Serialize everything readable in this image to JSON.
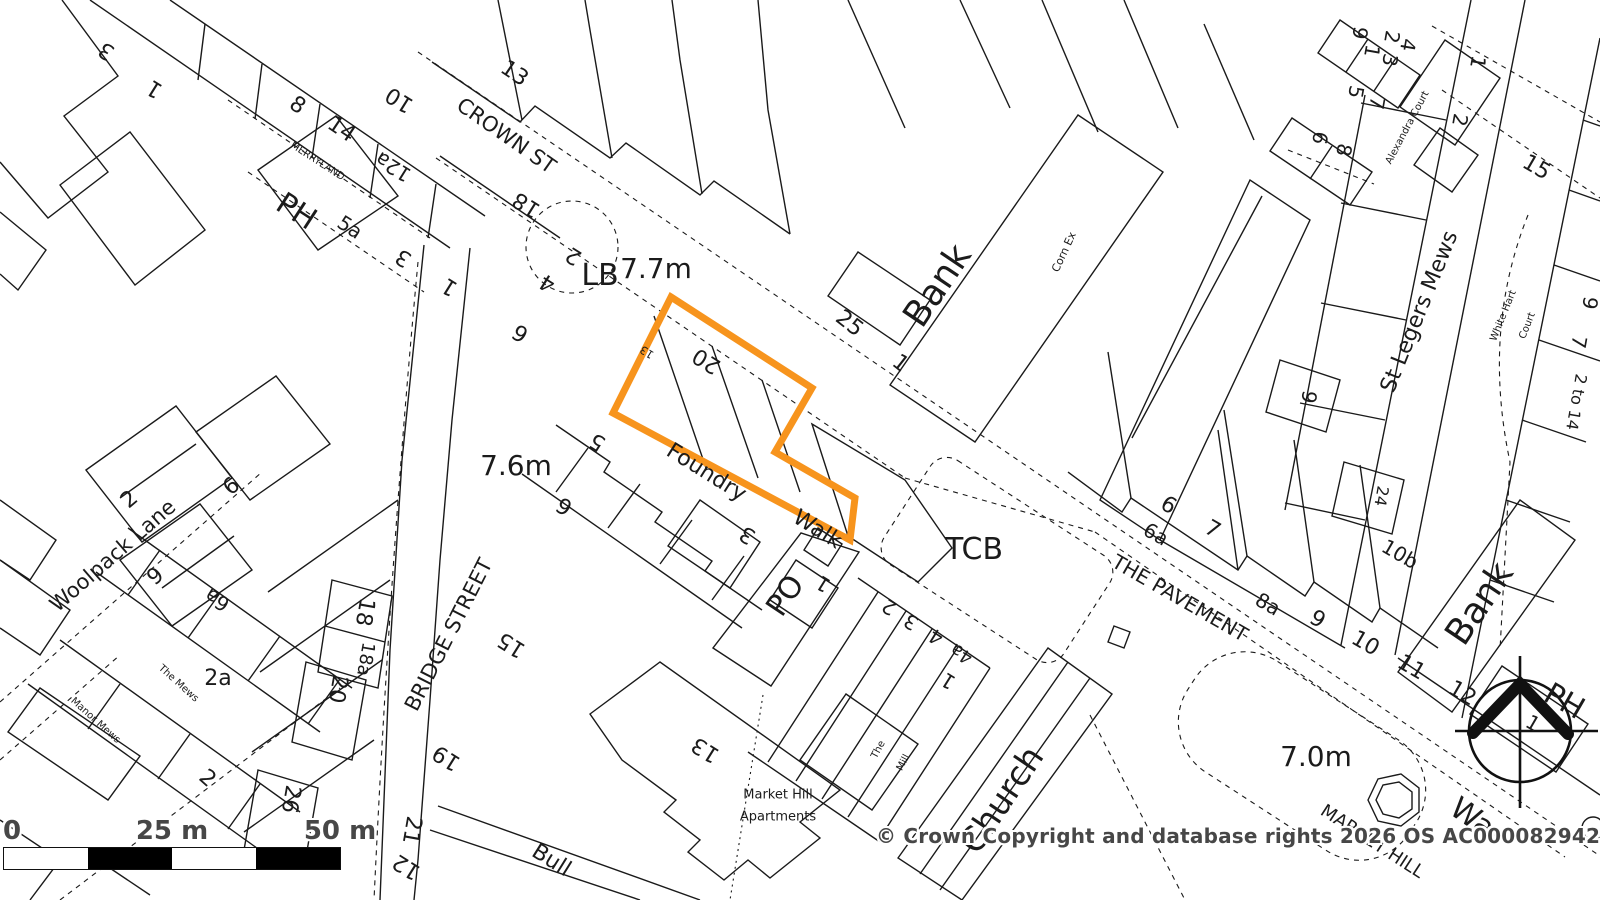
{
  "map": {
    "title": "OS planning map extract",
    "plot": {
      "points_str": "671,297 812,388 775,452 855,498 850,540 613,413",
      "color": "#f7941d"
    },
    "copyright": "© Crown Copyright and database rights 2026 OS AC0000829429",
    "scale_bar": {
      "zero": "0",
      "mid": "25 m",
      "end": "50 m"
    },
    "spot_heights": [
      "7.7m",
      "7.6m",
      "7.0m"
    ],
    "street_names": [
      "CROWN ST",
      "MERRYLAND",
      "BRIDGE STREET",
      "Woolpack Lane",
      "THE PAVEMENT",
      "St Legers Mews",
      "Foundry Walk",
      "MARKET HILL",
      "Bull"
    ],
    "place_names": [
      "PH",
      "LB",
      "TCB",
      "PO",
      "Bank",
      "Corn Ex",
      "Church",
      "War",
      "Alexandra Court",
      "White Hart Court",
      "The Mews",
      "Manor Mews",
      "Market Hill Apartments",
      "The Mill"
    ],
    "labels": [
      {
        "t": "3",
        "x": 107,
        "y": 50,
        "r": 212,
        "s": 22
      },
      {
        "t": "1",
        "x": 155,
        "y": 88,
        "r": 212,
        "s": 22
      },
      {
        "t": "8",
        "x": 297,
        "y": 106,
        "r": 34,
        "s": 22
      },
      {
        "t": "14",
        "x": 341,
        "y": 130,
        "r": 34,
        "s": 22
      },
      {
        "t": "MERRYLAND",
        "x": 317,
        "y": 162,
        "r": 33,
        "s": 10
      },
      {
        "t": "PH",
        "x": 296,
        "y": 212,
        "r": 33,
        "s": 30
      },
      {
        "t": "5a",
        "x": 350,
        "y": 227,
        "r": 33,
        "s": 20
      },
      {
        "t": "12a",
        "x": 393,
        "y": 167,
        "r": 212,
        "s": 20
      },
      {
        "t": "10",
        "x": 400,
        "y": 99,
        "r": 212,
        "s": 22
      },
      {
        "t": "13",
        "x": 514,
        "y": 74,
        "r": 34,
        "s": 22
      },
      {
        "t": "CROWN ST",
        "x": 506,
        "y": 136,
        "r": 35,
        "s": 21
      },
      {
        "t": "18",
        "x": 527,
        "y": 204,
        "r": 212,
        "s": 22
      },
      {
        "t": "3",
        "x": 404,
        "y": 257,
        "r": 212,
        "s": 22
      },
      {
        "t": "1",
        "x": 450,
        "y": 286,
        "r": 212,
        "s": 22
      },
      {
        "t": "2",
        "x": 574,
        "y": 255,
        "r": 212,
        "s": 22
      },
      {
        "t": "4",
        "x": 548,
        "y": 282,
        "r": 212,
        "s": 22
      },
      {
        "t": "6",
        "x": 521,
        "y": 332,
        "r": 212,
        "s": 22
      },
      {
        "t": "LB",
        "x": 600,
        "y": 276,
        "r": 0,
        "s": 30
      },
      {
        "t": "7.7m",
        "x": 656,
        "y": 269,
        "r": 0,
        "s": 28
      },
      {
        "t": "25",
        "x": 849,
        "y": 324,
        "r": 38,
        "s": 22
      },
      {
        "t": "1",
        "x": 900,
        "y": 364,
        "r": 38,
        "s": 22
      },
      {
        "t": "Bank",
        "x": 938,
        "y": 286,
        "r": -56,
        "s": 36
      },
      {
        "t": "Corn Ex",
        "x": 1064,
        "y": 252,
        "r": -65,
        "s": 11
      },
      {
        "t": "9",
        "x": 1360,
        "y": 33,
        "r": 100,
        "s": 20
      },
      {
        "t": "2",
        "x": 1392,
        "y": 37,
        "r": 100,
        "s": 20
      },
      {
        "t": "4",
        "x": 1408,
        "y": 45,
        "r": 100,
        "s": 20
      },
      {
        "t": "1",
        "x": 1372,
        "y": 51,
        "r": 100,
        "s": 20
      },
      {
        "t": "3",
        "x": 1390,
        "y": 60,
        "r": 100,
        "s": 20
      },
      {
        "t": "5",
        "x": 1356,
        "y": 92,
        "r": 100,
        "s": 20
      },
      {
        "t": "7",
        "x": 1377,
        "y": 103,
        "r": 100,
        "s": 20
      },
      {
        "t": "6",
        "x": 1320,
        "y": 138,
        "r": 100,
        "s": 20
      },
      {
        "t": "8",
        "x": 1344,
        "y": 150,
        "r": 100,
        "s": 20
      },
      {
        "t": "Alexandra Court",
        "x": 1408,
        "y": 128,
        "r": -62,
        "s": 10
      },
      {
        "t": "1",
        "x": 1478,
        "y": 62,
        "r": 100,
        "s": 20
      },
      {
        "t": "2",
        "x": 1460,
        "y": 120,
        "r": 100,
        "s": 20
      },
      {
        "t": "15",
        "x": 1536,
        "y": 168,
        "r": 30,
        "s": 22
      },
      {
        "t": "St Legers Mews",
        "x": 1420,
        "y": 312,
        "r": -68,
        "s": 22
      },
      {
        "t": "White Hart",
        "x": 1504,
        "y": 316,
        "r": -68,
        "s": 10
      },
      {
        "t": "Court",
        "x": 1528,
        "y": 326,
        "r": -68,
        "s": 10
      },
      {
        "t": "9",
        "x": 1590,
        "y": 303,
        "r": 100,
        "s": 20
      },
      {
        "t": "7",
        "x": 1579,
        "y": 342,
        "r": 100,
        "s": 20
      },
      {
        "t": "2 to 14",
        "x": 1576,
        "y": 402,
        "r": 100,
        "s": 16
      },
      {
        "t": "24",
        "x": 1381,
        "y": 496,
        "r": 100,
        "s": 16
      },
      {
        "t": "9",
        "x": 1309,
        "y": 397,
        "r": 100,
        "s": 20
      },
      {
        "t": "10b",
        "x": 1400,
        "y": 554,
        "r": 30,
        "s": 20
      },
      {
        "t": "Bank",
        "x": 1480,
        "y": 604,
        "r": -56,
        "s": 36
      },
      {
        "t": "6",
        "x": 1168,
        "y": 506,
        "r": 30,
        "s": 22
      },
      {
        "t": "6a",
        "x": 1156,
        "y": 534,
        "r": 30,
        "s": 20
      },
      {
        "t": "7",
        "x": 1212,
        "y": 530,
        "r": 30,
        "s": 22
      },
      {
        "t": "THE PAVEMENT",
        "x": 1180,
        "y": 598,
        "r": 30,
        "s": 20
      },
      {
        "t": "8a",
        "x": 1268,
        "y": 604,
        "r": 30,
        "s": 20
      },
      {
        "t": "9",
        "x": 1317,
        "y": 620,
        "r": 30,
        "s": 22
      },
      {
        "t": "10",
        "x": 1365,
        "y": 644,
        "r": 30,
        "s": 22
      },
      {
        "t": "11",
        "x": 1411,
        "y": 668,
        "r": 30,
        "s": 22
      },
      {
        "t": "12",
        "x": 1462,
        "y": 694,
        "r": 30,
        "s": 22
      },
      {
        "t": "PH",
        "x": 1564,
        "y": 702,
        "r": 30,
        "s": 30
      },
      {
        "t": "1",
        "x": 1533,
        "y": 723,
        "r": 30,
        "s": 20
      },
      {
        "t": "7.0m",
        "x": 1316,
        "y": 757,
        "r": 0,
        "s": 28
      },
      {
        "t": "MARKET HILL",
        "x": 1372,
        "y": 842,
        "r": 33,
        "s": 18
      },
      {
        "t": "War",
        "x": 1477,
        "y": 822,
        "r": 35,
        "s": 30
      },
      {
        "t": "Church",
        "x": 1002,
        "y": 800,
        "r": -56,
        "s": 34
      },
      {
        "t": "Market Hill",
        "x": 778,
        "y": 795,
        "r": 0,
        "s": 13
      },
      {
        "t": "Apartments",
        "x": 778,
        "y": 817,
        "r": 0,
        "s": 13
      },
      {
        "t": "The",
        "x": 879,
        "y": 750,
        "r": -62,
        "s": 10
      },
      {
        "t": "Mill",
        "x": 904,
        "y": 763,
        "r": -62,
        "s": 10
      },
      {
        "t": "13",
        "x": 706,
        "y": 749,
        "r": 212,
        "s": 22
      },
      {
        "t": "PO",
        "x": 786,
        "y": 596,
        "r": -56,
        "s": 30
      },
      {
        "t": "TCB",
        "x": 974,
        "y": 550,
        "r": 0,
        "s": 30
      },
      {
        "t": "3",
        "x": 748,
        "y": 534,
        "r": 212,
        "s": 22
      },
      {
        "t": "Foundry",
        "x": 706,
        "y": 473,
        "r": 32,
        "s": 22
      },
      {
        "t": "Walk",
        "x": 817,
        "y": 530,
        "r": 32,
        "s": 22
      },
      {
        "t": "1",
        "x": 823,
        "y": 584,
        "r": 212,
        "s": 20
      },
      {
        "t": "2",
        "x": 889,
        "y": 607,
        "r": 212,
        "s": 20
      },
      {
        "t": "3",
        "x": 911,
        "y": 622,
        "r": 212,
        "s": 20
      },
      {
        "t": "4",
        "x": 936,
        "y": 637,
        "r": 212,
        "s": 20
      },
      {
        "t": "4a",
        "x": 962,
        "y": 653,
        "r": 212,
        "s": 18
      },
      {
        "t": "1",
        "x": 948,
        "y": 681,
        "r": 212,
        "s": 20
      },
      {
        "t": "20",
        "x": 707,
        "y": 360,
        "r": 212,
        "s": 22
      },
      {
        "t": "13",
        "x": 647,
        "y": 352,
        "r": 212,
        "s": 11
      },
      {
        "t": "5",
        "x": 598,
        "y": 441,
        "r": 212,
        "s": 22
      },
      {
        "t": "6",
        "x": 565,
        "y": 505,
        "r": 212,
        "s": 22
      },
      {
        "t": "7.6m",
        "x": 516,
        "y": 466,
        "r": 0,
        "s": 28
      },
      {
        "t": "15",
        "x": 512,
        "y": 644,
        "r": 212,
        "s": 22
      },
      {
        "t": "19",
        "x": 447,
        "y": 757,
        "r": 212,
        "s": 22
      },
      {
        "t": "21",
        "x": 411,
        "y": 830,
        "r": 100,
        "s": 22
      },
      {
        "t": "12",
        "x": 407,
        "y": 866,
        "r": 212,
        "s": 22
      },
      {
        "t": "Bull",
        "x": 551,
        "y": 861,
        "r": 32,
        "s": 22
      },
      {
        "t": "BRIDGE STREET",
        "x": 449,
        "y": 635,
        "r": -63,
        "s": 21
      },
      {
        "t": "Woolpack Lane",
        "x": 113,
        "y": 556,
        "r": -41,
        "s": 21
      },
      {
        "t": "2",
        "x": 130,
        "y": 500,
        "r": -40,
        "s": 22
      },
      {
        "t": "6",
        "x": 232,
        "y": 487,
        "r": -40,
        "s": 22
      },
      {
        "t": "9",
        "x": 156,
        "y": 577,
        "r": -40,
        "s": 22
      },
      {
        "t": "6a",
        "x": 217,
        "y": 600,
        "r": 212,
        "s": 20
      },
      {
        "t": "18",
        "x": 364,
        "y": 612,
        "r": 100,
        "s": 22
      },
      {
        "t": "18a",
        "x": 365,
        "y": 659,
        "r": 100,
        "s": 18
      },
      {
        "t": "2a",
        "x": 218,
        "y": 679,
        "r": 0,
        "s": 22
      },
      {
        "t": "The Mews",
        "x": 178,
        "y": 684,
        "r": 42,
        "s": 10
      },
      {
        "t": "Manor Mews",
        "x": 95,
        "y": 721,
        "r": 42,
        "s": 10
      },
      {
        "t": "20",
        "x": 337,
        "y": 689,
        "r": 100,
        "s": 22
      },
      {
        "t": "26",
        "x": 290,
        "y": 799,
        "r": 100,
        "s": 22
      },
      {
        "t": "2",
        "x": 207,
        "y": 779,
        "r": 42,
        "s": 22
      }
    ]
  }
}
